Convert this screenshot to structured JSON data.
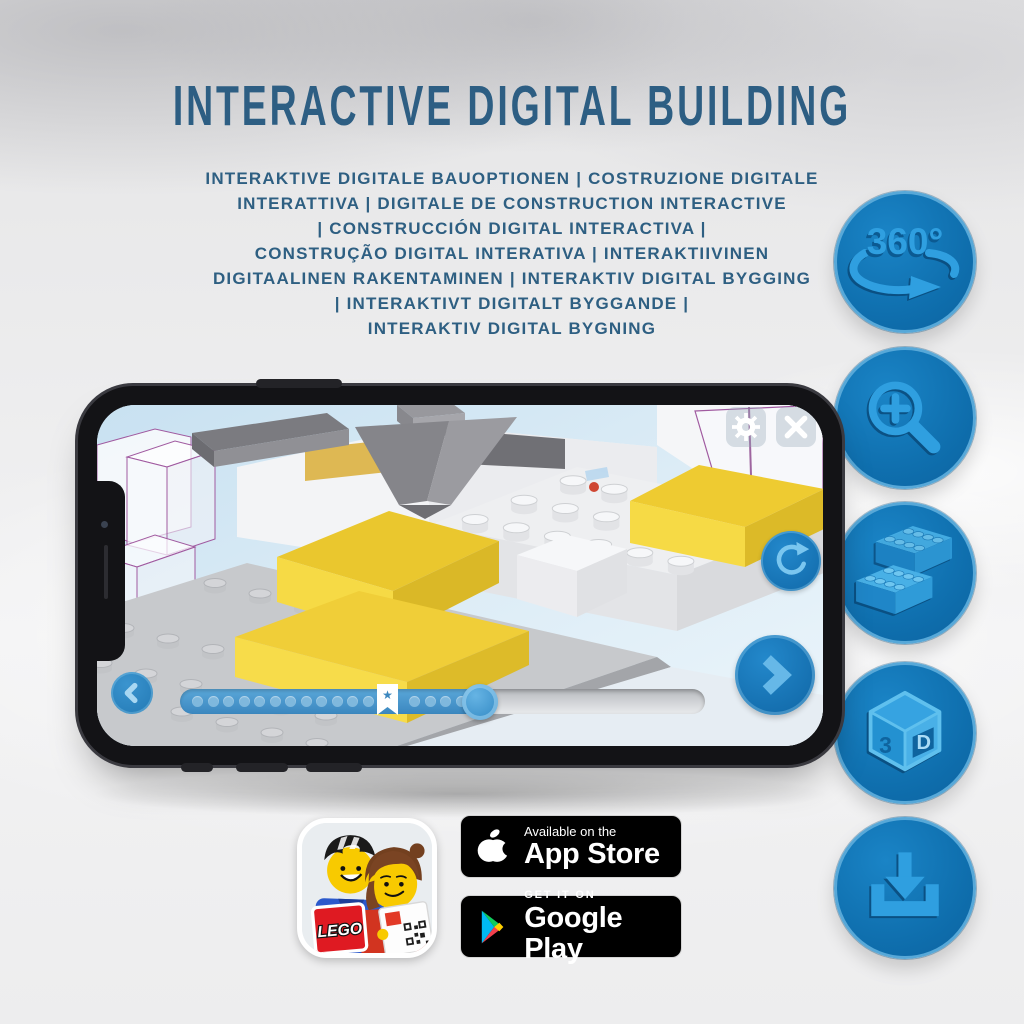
{
  "header": {
    "title": "INTERACTIVE DIGITAL BUILDING",
    "subtitle_lines": [
      "INTERAKTIVE DIGITALE BAUOPTIONEN | COSTRUZIONE DIGITALE",
      "INTERATTIVA | DIGITALE DE CONSTRUCTION INTERACTIVE",
      "| CONSTRUCCIÓN DIGITAL INTERACTIVA |",
      "CONSTRUÇÃO DIGITAL INTERATIVA | INTERAKTIIVINEN",
      "DIGITAALINEN RAKENTAMINEN | INTERAKTIV DIGITAL BYGGING",
      "| INTERAKTIVT DIGITALT BYGGANDE |",
      "INTERAKTIV DIGITAL BYGNING"
    ]
  },
  "features": {
    "rotation_label": "360°",
    "cube_3": "3",
    "cube_d": "D"
  },
  "app_ui": {
    "bookmark_star": "★"
  },
  "store": {
    "lego_logo": "LEGO",
    "app_store": {
      "tagline": "Available on the",
      "name": "App Store"
    },
    "google_play": {
      "tagline": "GET IT ON",
      "name": "Google Play"
    }
  },
  "colors": {
    "title_blue": "#2d5e83",
    "feature_circle_blue": "#0f6fae",
    "feature_glyph_blue": "#2f9fe0",
    "app_accent_blue": "#1d80c6",
    "highlight_yellow": "#f2d23a"
  }
}
